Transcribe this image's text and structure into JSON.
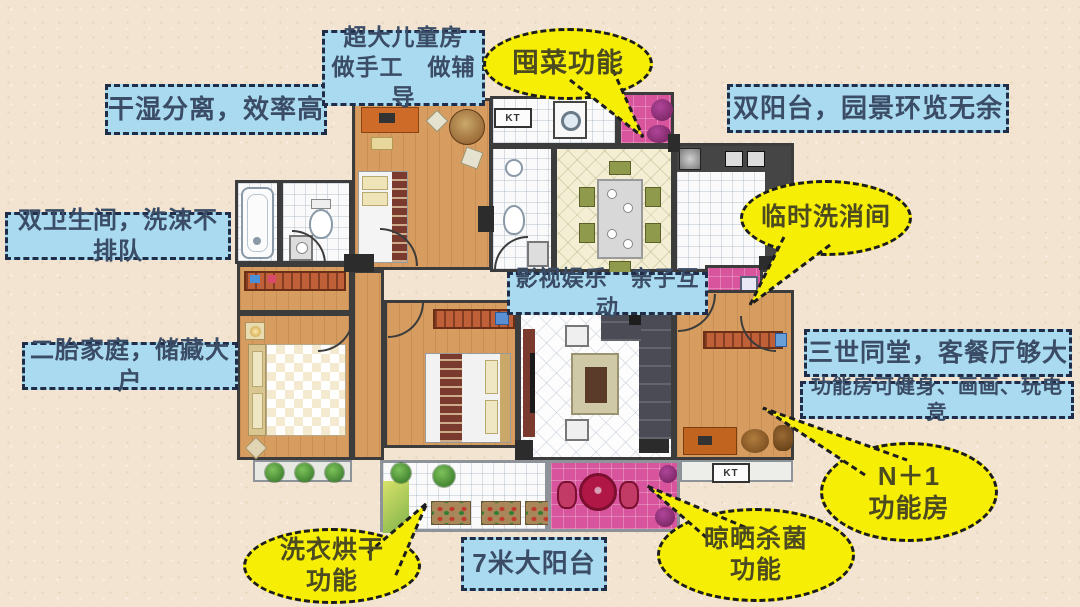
{
  "palette": {
    "background": "#f2e4d0",
    "label_blue_bg": "#a9daef",
    "label_blue_border": "#1f2d49",
    "label_blue_text": "#3b4c66",
    "bubble_yellow": "#f7ee06",
    "bubble_border": "#1c1c1c",
    "floor_wood": "#d79d60",
    "accent_pink": "#d8549c",
    "wall": "#3c3c3c"
  },
  "blue_labels": [
    {
      "id": "dry-wet-separation",
      "text": "干湿分离，效率高"
    },
    {
      "id": "kids-room",
      "text": "超大儿童房\n做手工　做辅导"
    },
    {
      "id": "double-balcony",
      "text": "双阳台，园景环览无余"
    },
    {
      "id": "two-bathrooms",
      "text": "双卫生间，洗涑不排队"
    },
    {
      "id": "media-parenting",
      "text": "影视娱乐　亲子互动"
    },
    {
      "id": "second-child-storage",
      "text": "二胎家庭，储藏大户"
    },
    {
      "id": "three-generations",
      "text": "三世同堂，客餐厅够大"
    },
    {
      "id": "function-room-uses",
      "text": "功能房可健身、画画、玩电竞"
    },
    {
      "id": "balcony-7m",
      "text": "7米大阳台"
    }
  ],
  "yellow_bubbles": [
    {
      "id": "stock-vegetables",
      "text": "囤菜功能"
    },
    {
      "id": "temporary-washroom",
      "text": "临时洗消间"
    },
    {
      "id": "n-plus-1-room",
      "text": "N＋1\n功能房"
    },
    {
      "id": "sun-dry-sterilize",
      "text": "晾晒杀菌\n功能"
    },
    {
      "id": "laundry-drying",
      "text": "洗衣烘干\n功能"
    }
  ],
  "floorplan": {
    "kt_label_top": "KT",
    "kt_label_bottom": "KT"
  }
}
